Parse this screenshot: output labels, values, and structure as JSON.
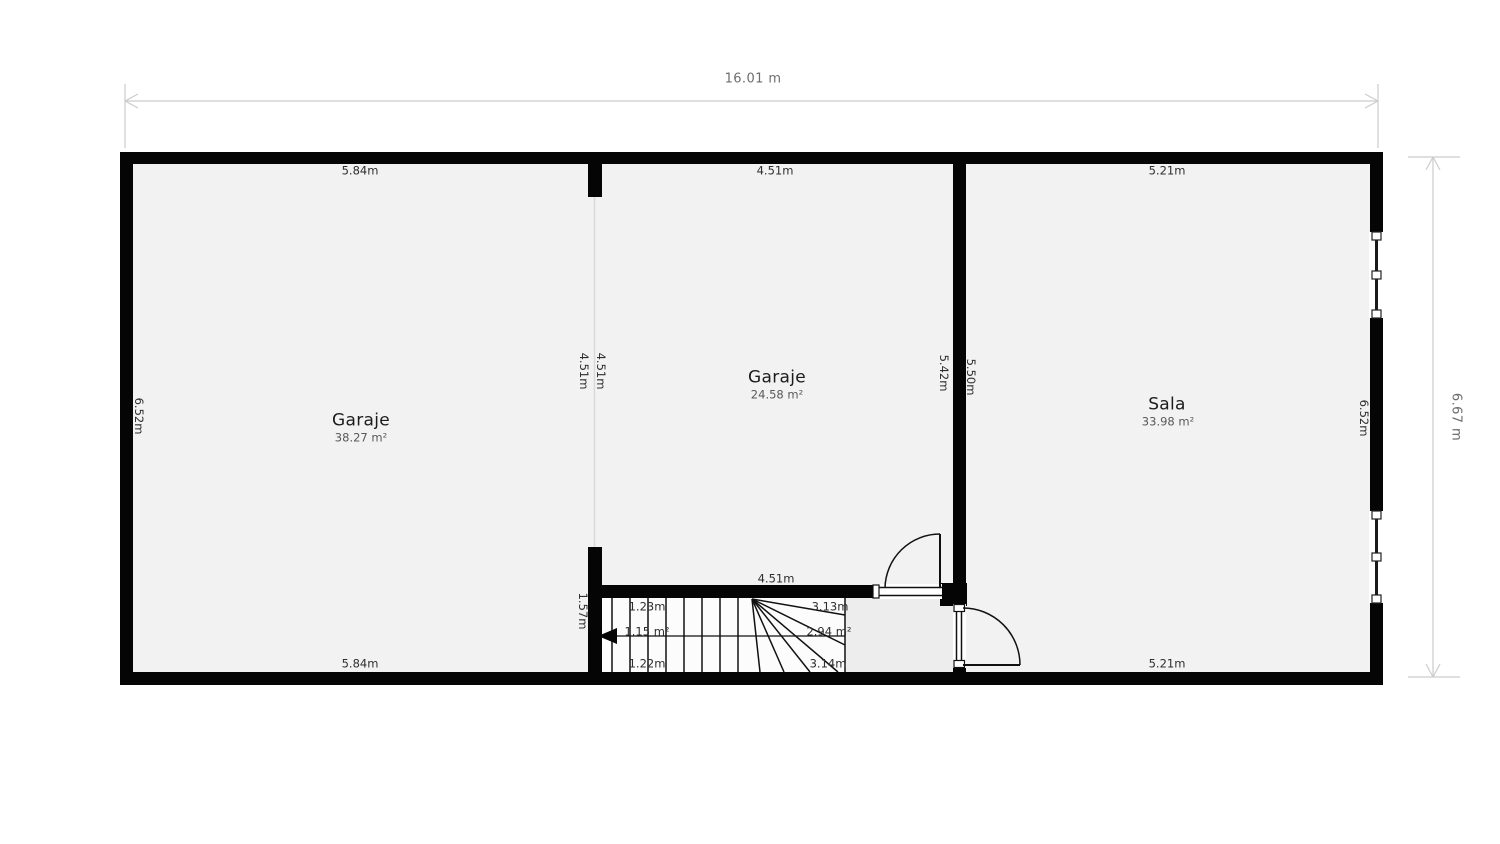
{
  "dimensions": {
    "total_width": "16.01 m",
    "total_height": "6.67 m"
  },
  "rooms": {
    "garage_left": {
      "name": "Garaje",
      "area": "38.27 m²",
      "dim_top": "5.84m",
      "dim_bottom": "5.84m",
      "dim_left": "6.52m",
      "dim_right": "4.51m"
    },
    "garage_mid": {
      "name": "Garaje",
      "area": "24.58 m²",
      "dim_top": "4.51m",
      "dim_bottom": "4.51m",
      "dim_left": "4.51m",
      "dim_right": "5.42m"
    },
    "sala": {
      "name": "Sala",
      "area": "33.98 m²",
      "dim_top": "5.21m",
      "dim_bottom": "5.21m",
      "dim_left": "5.50m",
      "dim_right": "6.52m"
    }
  },
  "stairs": {
    "dim_left": "1.57m",
    "dim_top_width": "1.23m",
    "dim_bottom_width": "1.22m",
    "dim_right_top": "3.13m",
    "dim_right_bottom": "3.14m",
    "area_lower_flight": "1.15 m²",
    "area_winder": "2.94 m²"
  },
  "colors": {
    "wall": "#050505",
    "floor": "#f2f2f2",
    "stair_floor": "#fcfcfc",
    "hallway_floor": "#ededed",
    "line": "#111111",
    "dimension_line": "#cccccc",
    "dimension_text": "#6e6e6e",
    "room_boundary": "#d9d9d9"
  }
}
